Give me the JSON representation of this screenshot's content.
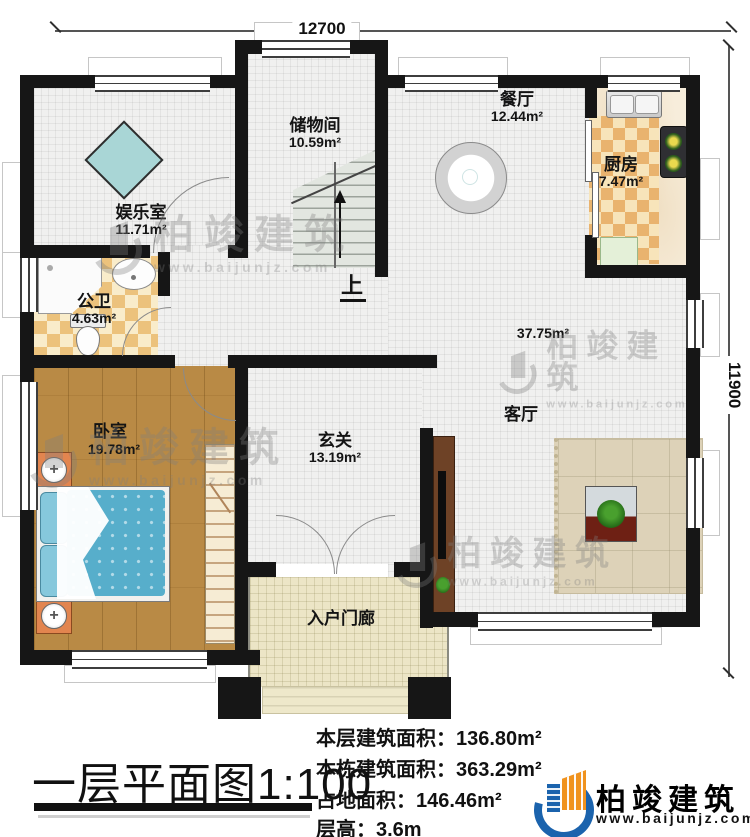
{
  "dimensions": {
    "width_mm": "12700",
    "height_mm": "11900"
  },
  "rooms": [
    {
      "id": "entertainment",
      "name": "娱乐室",
      "area": "11.71m²"
    },
    {
      "id": "storage",
      "name": "储物间",
      "area": "10.59m²"
    },
    {
      "id": "dining",
      "name": "餐厅",
      "area": "12.44m²"
    },
    {
      "id": "kitchen",
      "name": "厨房",
      "area": "7.47m²"
    },
    {
      "id": "bathroom",
      "name": "公卫",
      "area": "4.63m²"
    },
    {
      "id": "bedroom",
      "name": "卧室",
      "area": "19.78m²"
    },
    {
      "id": "foyer",
      "name": "玄关",
      "area": "13.19m²"
    },
    {
      "id": "living",
      "name": "客厅",
      "area": "37.75m²"
    },
    {
      "id": "porch",
      "name": "入户门廊",
      "area": ""
    }
  ],
  "stairs": {
    "label": "上"
  },
  "footer": {
    "title": "一层平面图1:100",
    "stats": [
      {
        "label": "本层建筑面积：",
        "value": "136.80m²"
      },
      {
        "label": "本栋建筑面积：",
        "value": "363.29m²"
      },
      {
        "label": "占地面积：",
        "value": "146.46m²"
      },
      {
        "label": "层高：",
        "value": "3.6m"
      }
    ]
  },
  "brand": {
    "name": "柏竣建筑",
    "url": "www.baijunjz.com",
    "colors": {
      "blue": "#1b63ad",
      "orange": "#f0931f"
    }
  }
}
